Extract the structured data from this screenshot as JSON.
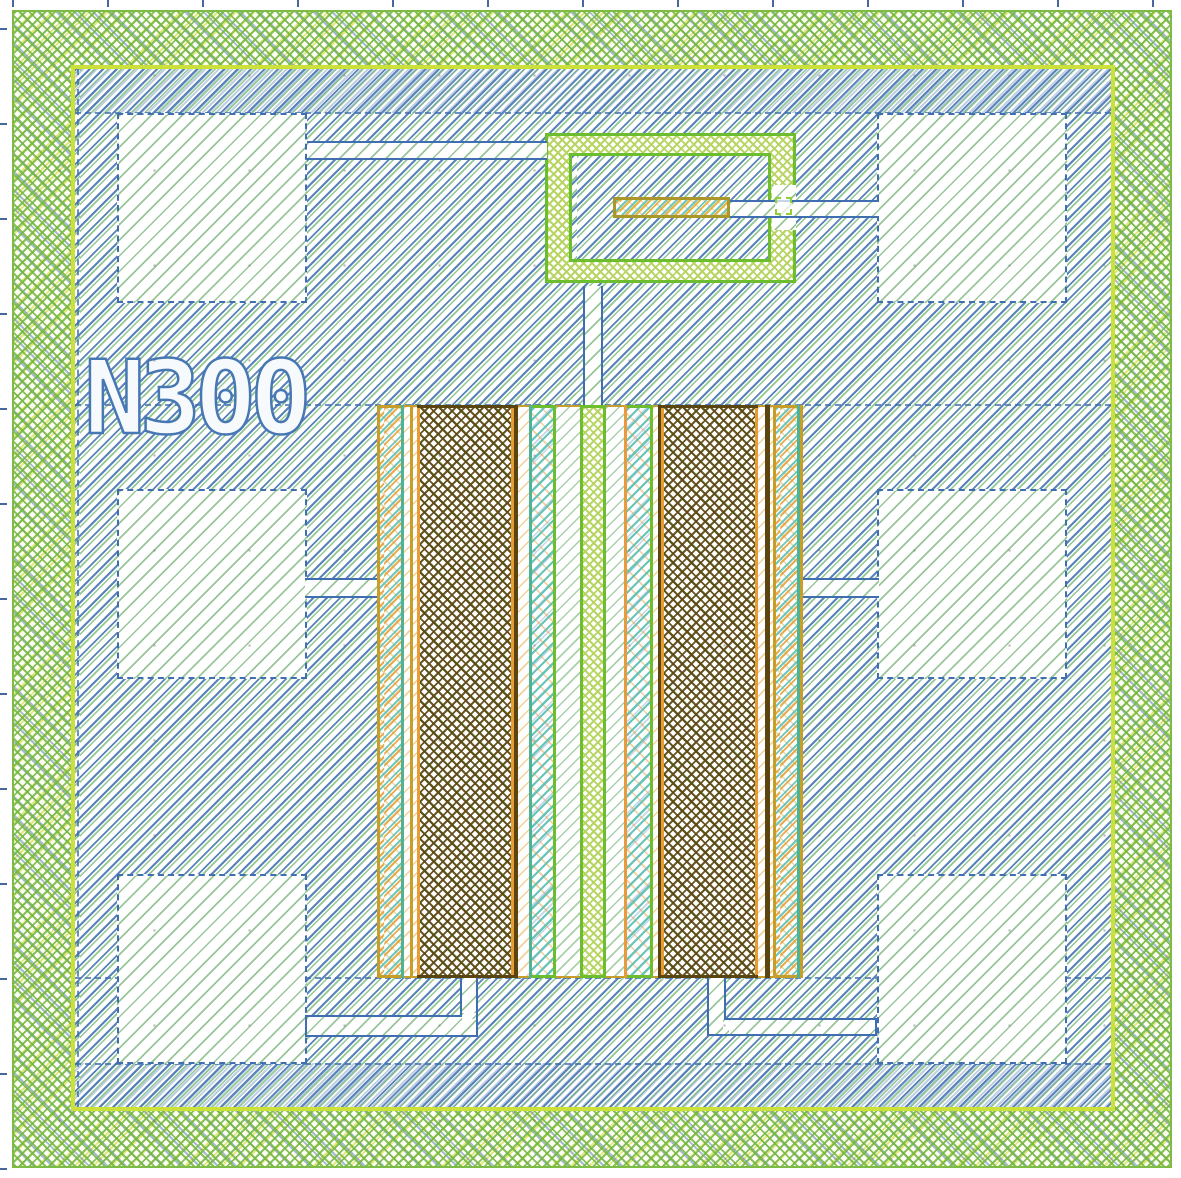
{
  "app": {
    "type": "ic-layout-viewer-canvas",
    "canvas_width_px": 1181,
    "canvas_height_px": 1178
  },
  "cell": {
    "label": "N300"
  },
  "colors": {
    "metal_hatch_blue": "#4876b2",
    "shape_outline_blue": "#3f6fb0",
    "diffusion_green": "#7cbc44",
    "well_accent_chartreuse": "#cbe13a",
    "poly_green": "#6cbe2e",
    "contact_ochre": "#c89e2a",
    "implant_orange": "#e89a3c",
    "gate_dark_brown": "#5a4410",
    "via_teal": "#50b294",
    "pad_fill_green": "#86bc86"
  },
  "ruler": {
    "tick_spacing_px": 95,
    "tick_origin_x": 12,
    "tick_origin_y": 28,
    "tick_count": 13
  },
  "layout": {
    "field_ring": {
      "x": 12,
      "y": 10,
      "w": 1160,
      "h": 1158
    },
    "accent_frame": {
      "x": 71,
      "y": 65,
      "w": 1044,
      "h": 1046
    },
    "inner_region": {
      "x": 75,
      "y": 69,
      "w": 1036,
      "h": 1038
    },
    "dense_strips": [
      {
        "x": 75,
        "y": 69,
        "w": 1036,
        "h": 44
      },
      {
        "x": 75,
        "y": 1063,
        "w": 1036,
        "h": 44
      }
    ],
    "layer_lines": [
      {
        "type": "h",
        "x": 75,
        "y": 112,
        "len": 1036
      },
      {
        "type": "h",
        "x": 75,
        "y": 1063,
        "len": 1036
      },
      {
        "type": "h",
        "x": 75,
        "y": 404,
        "len": 1036
      },
      {
        "type": "h",
        "x": 75,
        "y": 977,
        "len": 1036
      },
      {
        "type": "v",
        "x": 77,
        "y": 69,
        "len": 1038
      }
    ],
    "pads": [
      {
        "name": "pad-top-left",
        "x": 117,
        "y": 113,
        "w": 190,
        "h": 190
      },
      {
        "name": "pad-top-right",
        "x": 877,
        "y": 113,
        "w": 190,
        "h": 190
      },
      {
        "name": "pad-mid-left",
        "x": 117,
        "y": 489,
        "w": 190,
        "h": 190
      },
      {
        "name": "pad-mid-right",
        "x": 877,
        "y": 489,
        "w": 190,
        "h": 190
      },
      {
        "name": "pad-bottom-left",
        "x": 117,
        "y": 874,
        "w": 190,
        "h": 190
      },
      {
        "name": "pad-bottom-right",
        "x": 877,
        "y": 874,
        "w": 190,
        "h": 190
      }
    ],
    "traces": [
      {
        "name": "trace-topleft-pad-to-guard-ring",
        "x": 307,
        "y": 141,
        "w": 240,
        "h": 19,
        "border": "tb"
      },
      {
        "name": "trace-bar-to-topright-pad",
        "x": 730,
        "y": 200,
        "w": 149,
        "h": 18,
        "border": "tb"
      },
      {
        "name": "trace-midleft-pad-to-structure",
        "x": 305,
        "y": 578,
        "w": 74,
        "h": 20,
        "border": "tb"
      },
      {
        "name": "trace-structure-to-midright-pad",
        "x": 801,
        "y": 578,
        "w": 78,
        "h": 20,
        "border": "tb"
      },
      {
        "name": "trace-guard-ring-to-gate",
        "x": 583,
        "y": 286,
        "w": 20,
        "h": 121,
        "border": "lr"
      },
      {
        "name": "trace-bottomleft-vertical",
        "x": 460,
        "y": 976,
        "w": 18,
        "h": 41,
        "border": "all"
      },
      {
        "name": "trace-bottomleft-horizontal",
        "x": 305,
        "y": 1015,
        "w": 173,
        "h": 22,
        "border": "all"
      },
      {
        "name": "trace-bottomright-vertical",
        "x": 707,
        "y": 976,
        "w": 19,
        "h": 60,
        "border": "all"
      },
      {
        "name": "trace-bottomright-horizontal",
        "x": 726,
        "y": 1018,
        "w": 151,
        "h": 18,
        "border": "all"
      }
    ],
    "trace_patches": [
      {
        "x": 462,
        "y": 1013,
        "w": 14,
        "h": 6
      },
      {
        "x": 723,
        "y": 1020,
        "w": 6,
        "h": 14
      }
    ],
    "guard_ring": {
      "outer": {
        "x": 545,
        "y": 133,
        "w": 251,
        "h": 150
      },
      "hole": {
        "x": 569,
        "y": 153,
        "w": 202,
        "h": 109
      },
      "gap": {
        "x": 772,
        "y": 185,
        "w": 24,
        "h": 45
      },
      "contact": {
        "x": 775,
        "y": 197,
        "w": 17,
        "h": 18
      },
      "bar": {
        "x": 613,
        "y": 197,
        "w": 117,
        "h": 21
      }
    },
    "transistor": {
      "y": 405,
      "h": 573,
      "columns": [
        {
          "x": 377,
          "w": 3,
          "t": "ochre"
        },
        {
          "x": 380,
          "w": 21,
          "t": "sd"
        },
        {
          "x": 401,
          "w": 3,
          "t": "tealline"
        },
        {
          "x": 404,
          "w": 6,
          "t": "ws"
        },
        {
          "x": 410,
          "w": 3,
          "t": "ochre"
        },
        {
          "x": 413,
          "w": 4,
          "t": "ws"
        },
        {
          "x": 417,
          "w": 97,
          "t": "dark"
        },
        {
          "x": 514,
          "w": 4,
          "t": "brown"
        },
        {
          "x": 518,
          "w": 11,
          "t": "ws"
        },
        {
          "x": 529,
          "w": 3,
          "t": "tealline"
        },
        {
          "x": 532,
          "w": 21,
          "t": "teal"
        },
        {
          "x": 553,
          "w": 3,
          "t": "green"
        },
        {
          "x": 556,
          "w": 24,
          "t": "wsg"
        },
        {
          "x": 580,
          "w": 3,
          "t": "green"
        },
        {
          "x": 583,
          "w": 20,
          "t": "poly"
        },
        {
          "x": 603,
          "w": 3,
          "t": "green"
        },
        {
          "x": 606,
          "w": 18,
          "t": "wsg"
        },
        {
          "x": 624,
          "w": 3,
          "t": "orange"
        },
        {
          "x": 627,
          "w": 23,
          "t": "teal"
        },
        {
          "x": 650,
          "w": 3,
          "t": "green"
        },
        {
          "x": 653,
          "w": 5,
          "t": "ws"
        },
        {
          "x": 658,
          "w": 3,
          "t": "brown"
        },
        {
          "x": 661,
          "w": 97,
          "t": "dark"
        },
        {
          "x": 758,
          "w": 7,
          "t": "ws"
        },
        {
          "x": 765,
          "w": 5,
          "t": "brown"
        },
        {
          "x": 770,
          "w": 3,
          "t": "ws"
        },
        {
          "x": 773,
          "w": 3,
          "t": "ochre"
        },
        {
          "x": 776,
          "w": 21,
          "t": "sd"
        },
        {
          "x": 797,
          "w": 3,
          "t": "tealline"
        },
        {
          "x": 800,
          "w": 3,
          "t": "ochre"
        }
      ]
    }
  }
}
